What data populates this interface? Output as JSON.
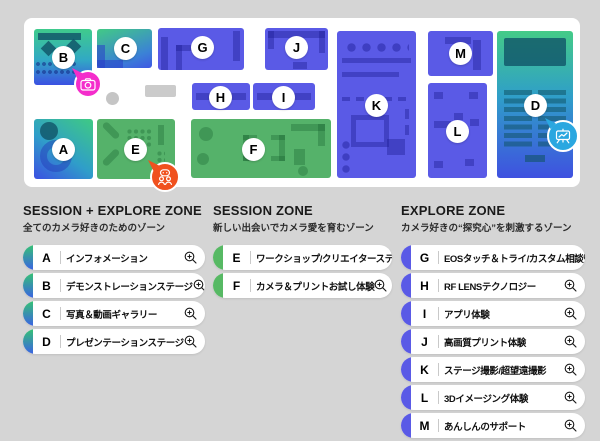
{
  "map": {
    "zones": {
      "a": "A",
      "b": "B",
      "c": "C",
      "d": "D",
      "e": "E",
      "f": "F",
      "g": "G",
      "h": "H",
      "i": "I",
      "j": "J",
      "k": "K",
      "l": "L",
      "m": "M"
    },
    "markers": {
      "camera": {
        "icon": "camera-icon",
        "color": "#f42dcb"
      },
      "visitors": {
        "icon": "visitors-icon",
        "color": "#f0511e"
      },
      "presentation": {
        "icon": "presentation-board-icon",
        "color": "#2aa7e0"
      }
    }
  },
  "legend": {
    "col1": {
      "title": "SESSION + EXPLORE ZONE",
      "subtitle": "全てのカメラ好きのためのゾーン",
      "accent": "green-blue-gradient",
      "items": [
        {
          "letter": "A",
          "label": "インフォメーション"
        },
        {
          "letter": "B",
          "label": "デモンストレーションステージ"
        },
        {
          "letter": "C",
          "label": "写真＆動画ギャラリー"
        },
        {
          "letter": "D",
          "label": "プレゼンテーションステージ"
        }
      ]
    },
    "col2": {
      "title": "SESSION ZONE",
      "subtitle": "新しい出会いでカメラ愛を育むゾーン",
      "accent": "#57b964",
      "items": [
        {
          "letter": "E",
          "label": "ワークショップ/クリエイターステージ"
        },
        {
          "letter": "F",
          "label": "カメラ＆プリントお試し体験"
        }
      ]
    },
    "col3": {
      "title": "EXPLORE ZONE",
      "subtitle": "カメラ好きの“探究心”を刺激するゾーン",
      "accent": "#5a5ae6",
      "items": [
        {
          "letter": "G",
          "label": "EOSタッチ＆トライ/カスタム相談"
        },
        {
          "letter": "H",
          "label": "RF LENSテクノロジー"
        },
        {
          "letter": "I",
          "label": "アプリ体験"
        },
        {
          "letter": "J",
          "label": "高画質プリント体験"
        },
        {
          "letter": "K",
          "label": "ステージ撮影/超望遠撮影"
        },
        {
          "letter": "L",
          "label": "3Dイメージング体験"
        },
        {
          "letter": "M",
          "label": "あんしんのサポート"
        }
      ]
    }
  },
  "colors": {
    "background": "#d5d5d5",
    "map_panel": "#ffffff",
    "purple_zone": "#5a5ae6",
    "green_zone": "#55b26a",
    "gradient_green": "#3fcb8c",
    "gradient_blue": "#3b50e2",
    "teal_accent": "#1f6b80",
    "marker_pink": "#f42dcb",
    "marker_orange": "#f0511e",
    "marker_blue": "#2aa7e0"
  }
}
